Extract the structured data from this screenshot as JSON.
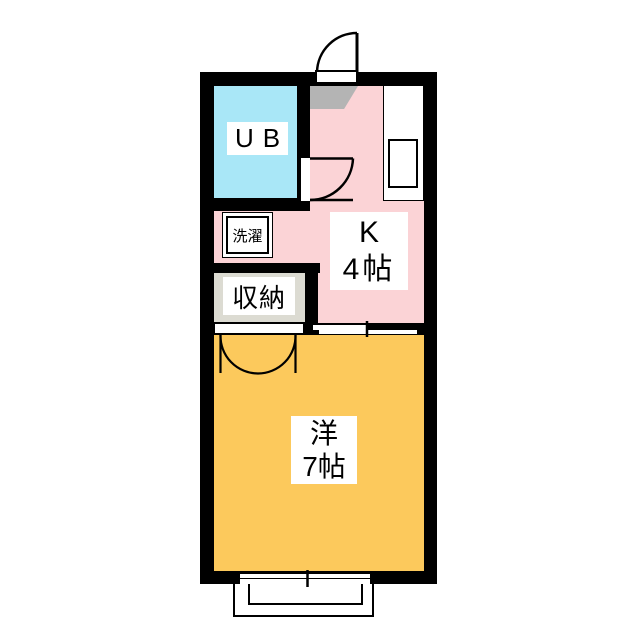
{
  "floorplan": {
    "type": "japanese-apartment-1K",
    "rooms": {
      "unit_bath": {
        "label": "UB",
        "fill": "#a9e7f7"
      },
      "kitchen": {
        "label": "K",
        "size": "4帖",
        "fill": "#fbd3d6"
      },
      "western_room": {
        "label": "洋",
        "size": "7帖",
        "fill": "#fcc95c"
      }
    },
    "fixtures": {
      "laundry": {
        "label": "洗濯"
      },
      "closet": {
        "label": "収納",
        "fill": "#dcdbd2"
      },
      "entry": {
        "fill": "#b4b4b4"
      }
    },
    "colors": {
      "wall": "#000000",
      "background": "#ffffff"
    }
  }
}
